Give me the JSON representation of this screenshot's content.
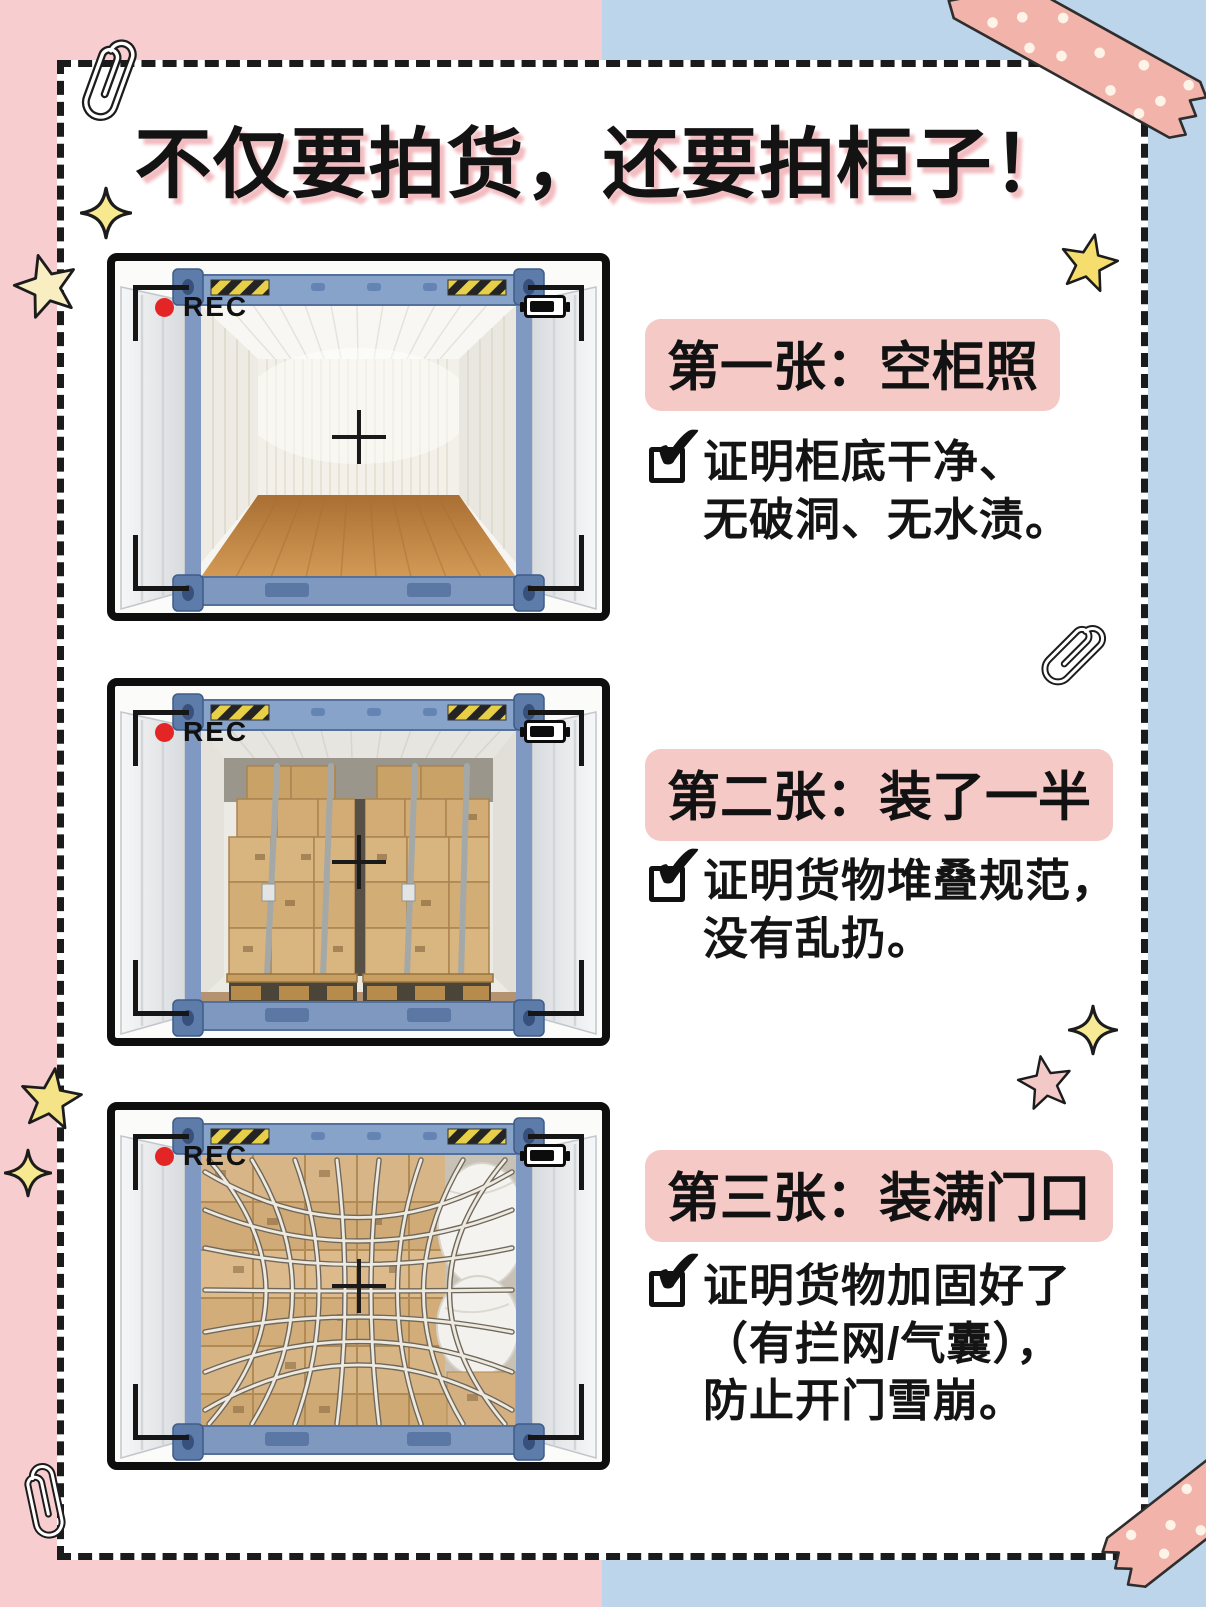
{
  "title": "不仅要拍货，还要拍柜子！",
  "camera": {
    "rec_label": "REC"
  },
  "icons": {
    "check": "✔"
  },
  "sections": [
    {
      "id": "empty-container",
      "heading": "第一张：空柜照",
      "lines": [
        "证明柜底干净、",
        "无破洞、无水渍。"
      ]
    },
    {
      "id": "half-loaded",
      "heading": "第二张：装了一半",
      "lines": [
        "证明货物堆叠规范，",
        "没有乱扔。"
      ]
    },
    {
      "id": "fully-loaded-door",
      "heading": "第三张：装满门口",
      "lines": [
        "证明货物加固好了",
        "（有拦网/气囊），",
        "防止开门雪崩。"
      ]
    }
  ],
  "colors": {
    "bg_left": "#f8cdcf",
    "bg_right": "#bdd5ea",
    "card": "#ffffff",
    "accent_pink": "#f5c9c6",
    "title_shadow": "#f2bcc0",
    "ink": "#141414",
    "rec_red": "#e42525",
    "tape_pink": "#f2b4aa"
  }
}
